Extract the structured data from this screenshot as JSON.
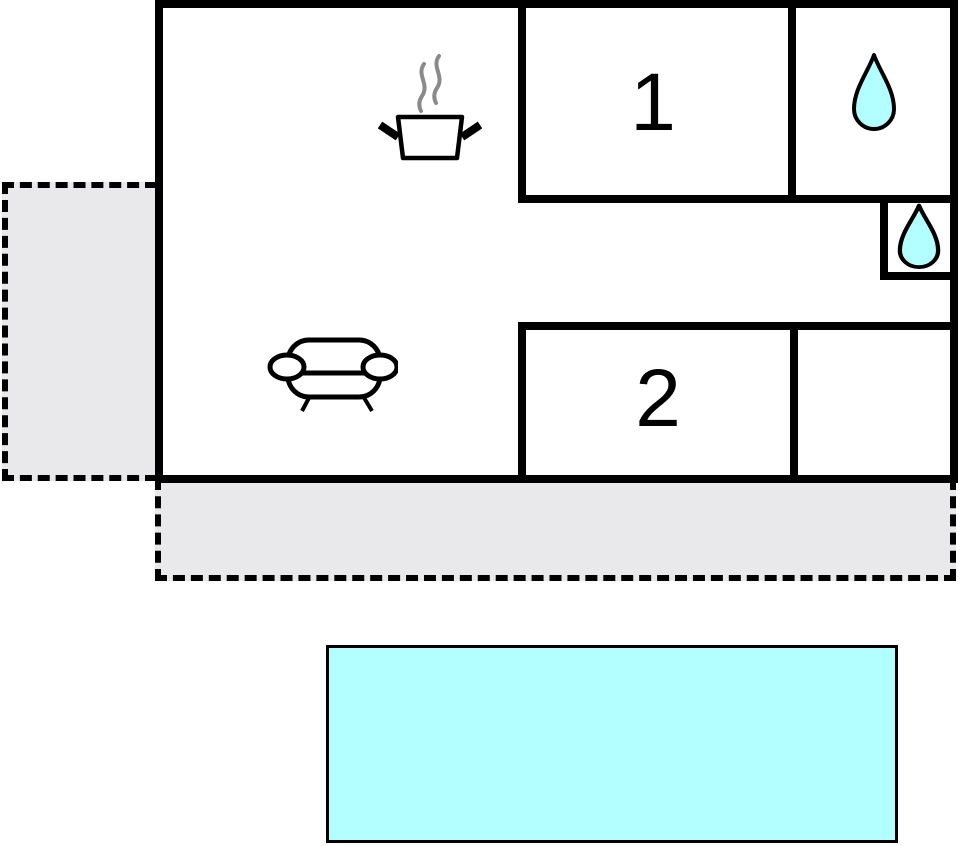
{
  "rooms": [
    {
      "label": "1"
    },
    {
      "label": "2"
    }
  ],
  "icons": [
    {
      "name": "cooking-pot-icon"
    },
    {
      "name": "steam-icon"
    },
    {
      "name": "sofa-icon"
    },
    {
      "name": "water-drop-icon-large"
    },
    {
      "name": "water-drop-icon-small"
    }
  ],
  "areas": [
    {
      "name": "main-building"
    },
    {
      "name": "terrace-left"
    },
    {
      "name": "terrace-bottom"
    },
    {
      "name": "swimming-pool"
    }
  ],
  "colors": {
    "wall": "#000000",
    "water": "#b3feff",
    "terrace": "#e9e9eb",
    "steam": "#8a8a8a"
  }
}
